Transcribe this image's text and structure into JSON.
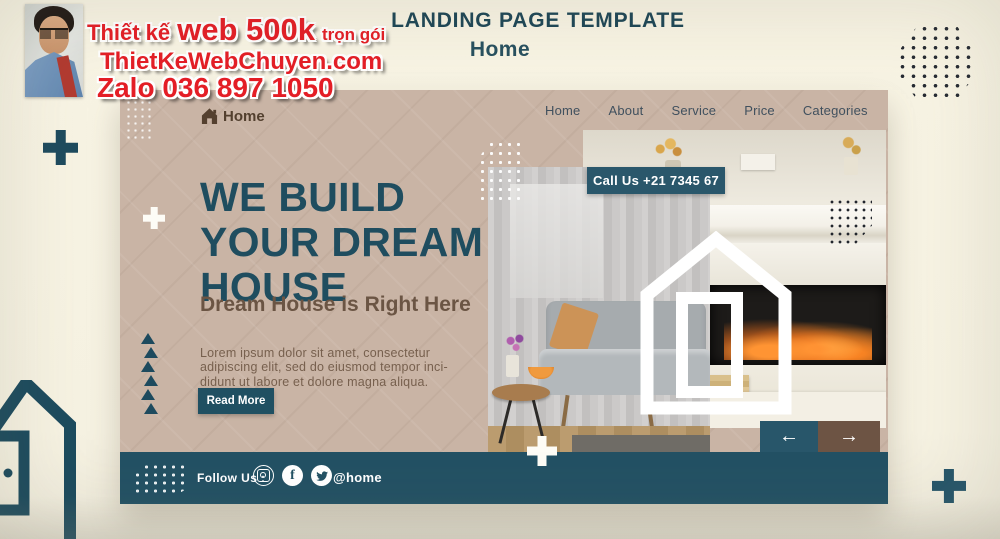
{
  "watermark": {
    "line1_pre": "Thiết kế",
    "line1_big": "web 500k",
    "line1_post": "trọn gói",
    "line2": "ThietKeWebChuyen.com",
    "line3": "Zalo 036 897 1050"
  },
  "header": {
    "title": "LANDING PAGE TEMPLATE",
    "subtitle": "Home"
  },
  "template": {
    "nav": {
      "logo_label": "Home",
      "items": [
        {
          "label": "Home"
        },
        {
          "label": "About"
        },
        {
          "label": "Service"
        },
        {
          "label": "Price"
        },
        {
          "label": "Categories"
        }
      ]
    },
    "hero": {
      "heading_lines": [
        "WE BUILD",
        "YOUR DREAM",
        "HOUSE"
      ],
      "tagline": "Dream House is Right Here",
      "body_lines": [
        "Lorem ipsum dolor sit amet, consectetur",
        "adipiscing elit, sed do eiusmod tempor inci-",
        "didunt ut labore et dolore magna aliqua."
      ],
      "cta_label": "Read More",
      "call_badge": "Call Us +21 7345 67"
    },
    "footer": {
      "follow_label": "Follow Us :",
      "handle": "@home"
    }
  },
  "icons": {
    "arrow_left": "←",
    "arrow_right": "→",
    "facebook": "f"
  },
  "colors": {
    "teal": "#1f4e60",
    "footer_teal": "#235164",
    "tan": "#c9b4a5",
    "cream": "#f7f3e3",
    "brown_text": "#6b5544",
    "arrow_brown": "#6d5444",
    "watermark_red": "#e41e26"
  }
}
